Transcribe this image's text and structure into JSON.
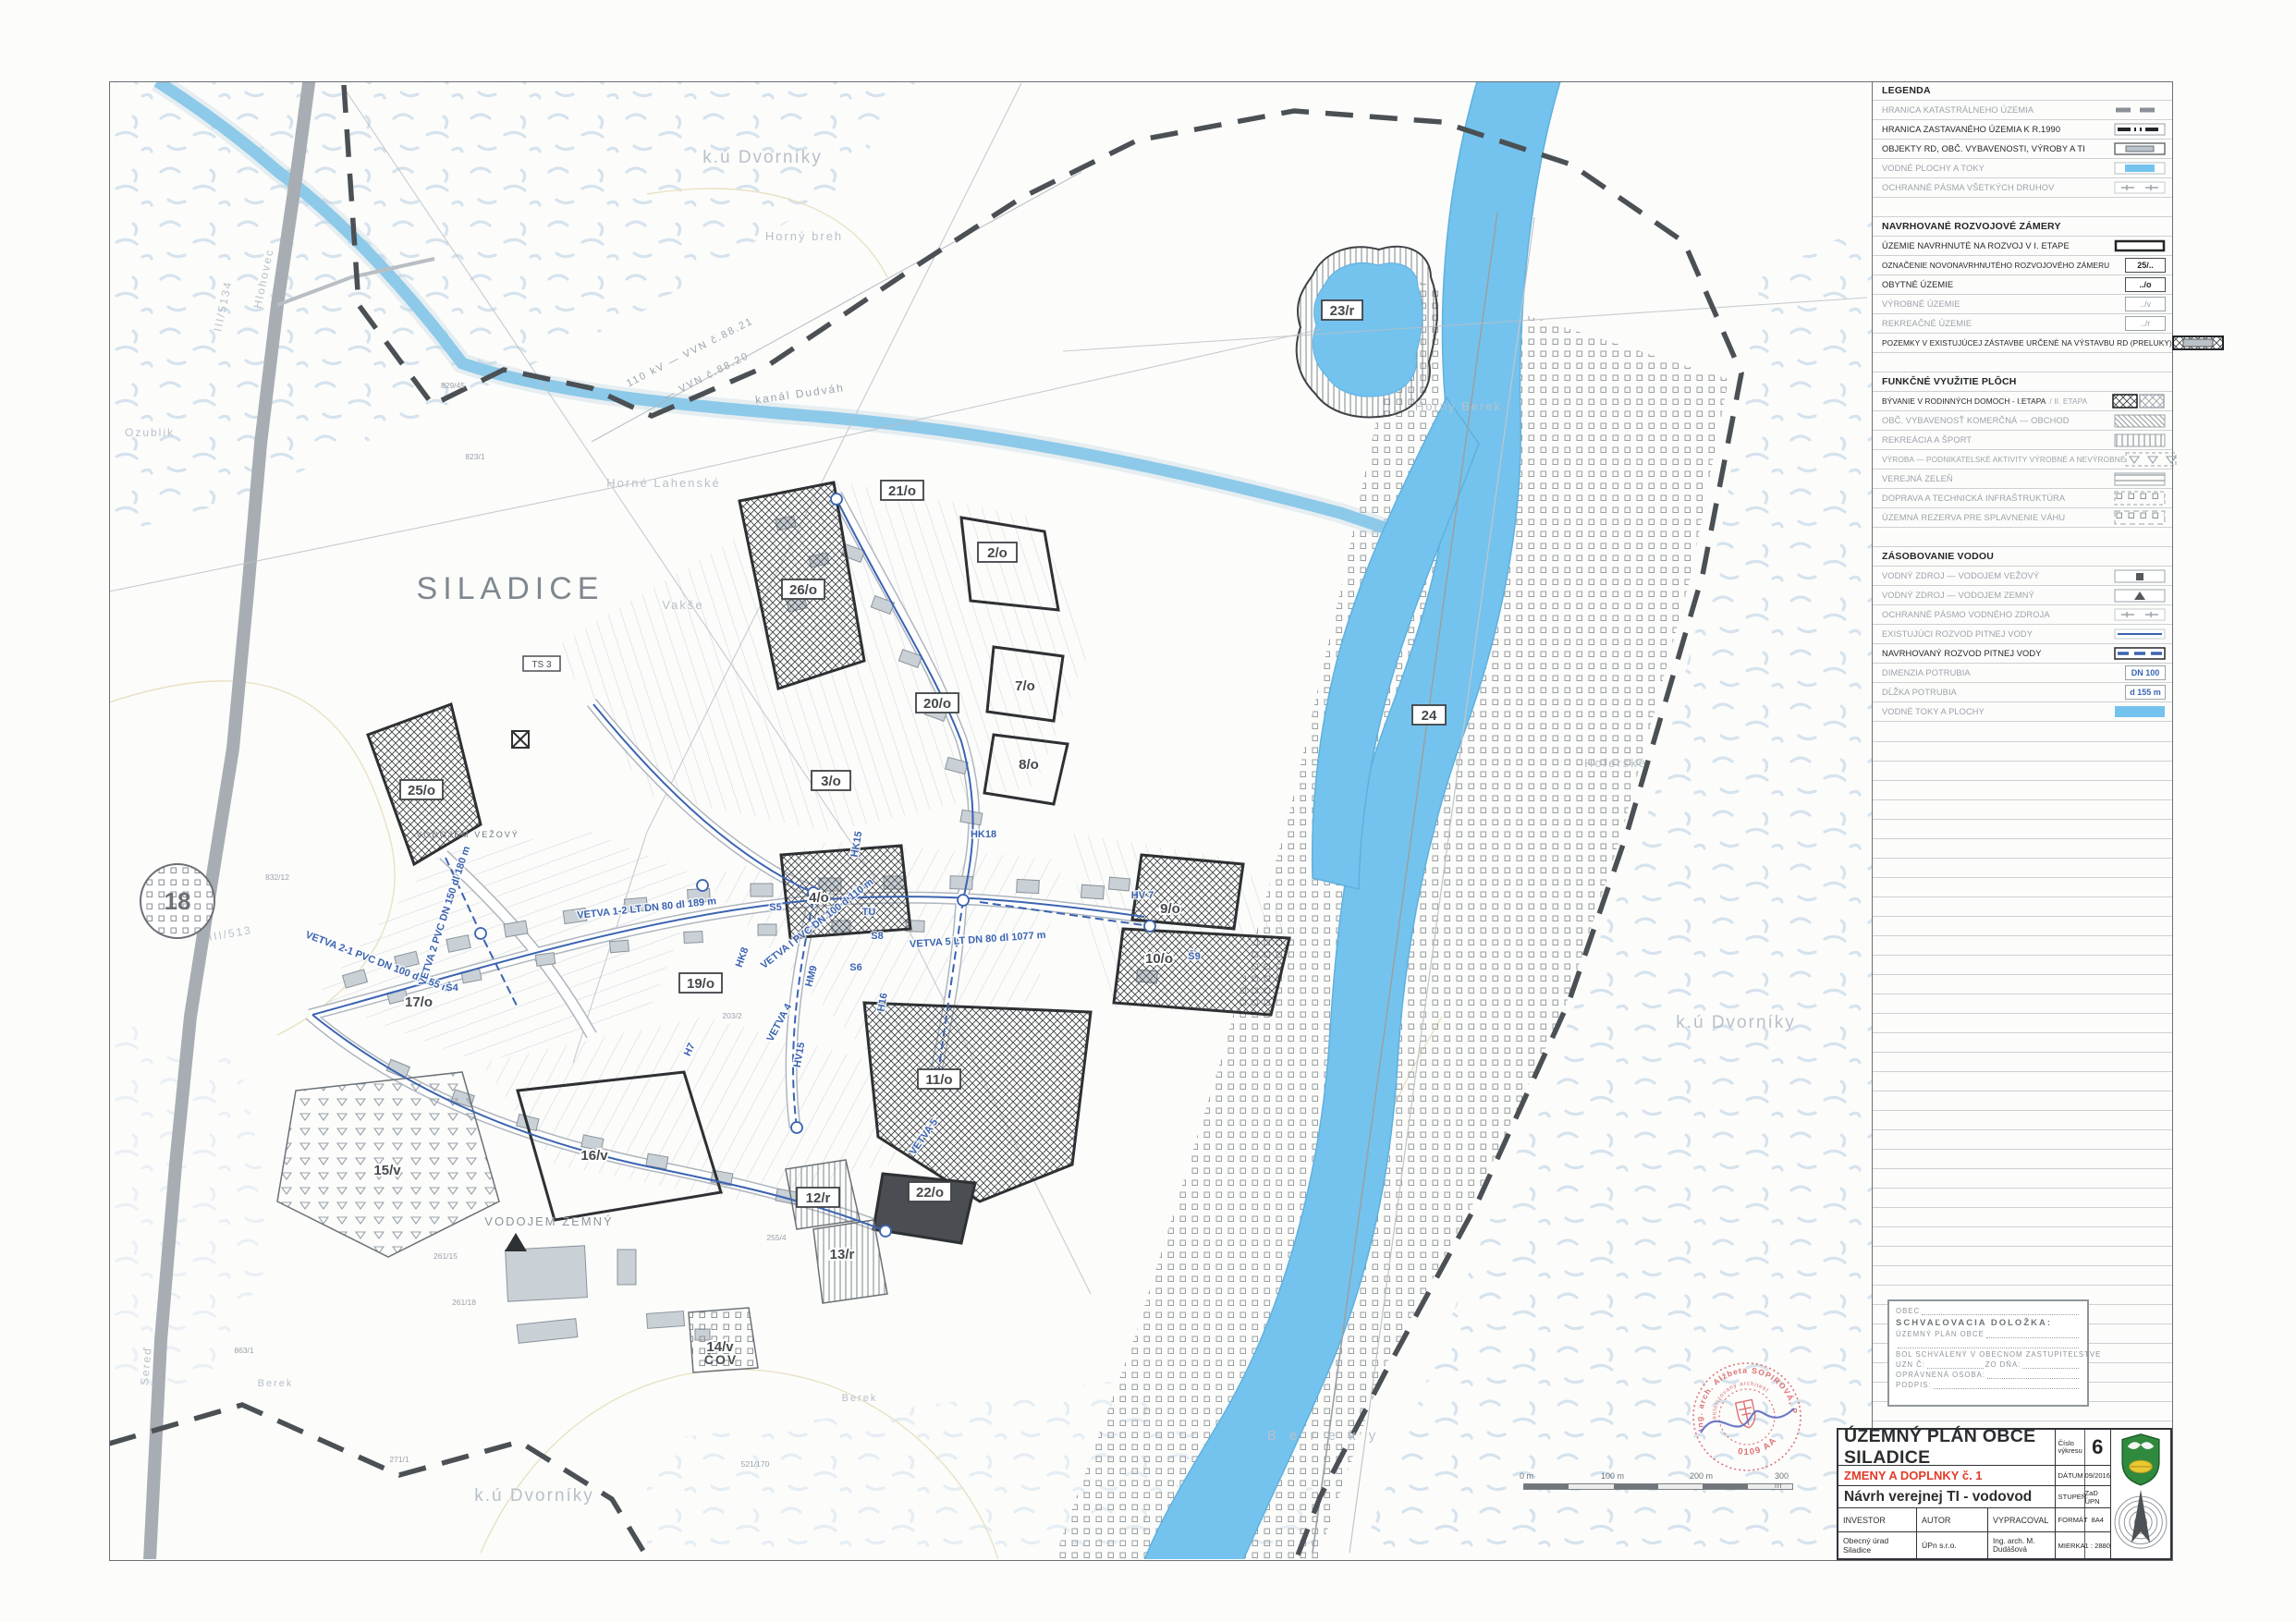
{
  "legend": {
    "title": "LEGENDA",
    "sections": [
      {
        "header": null,
        "items": [
          {
            "label": "HRANICA KATASTRÁLNEHO ÚZEMIA"
          },
          {
            "label": "HRANICA ZASTAVANÉHO ÚZEMIA K R.1990"
          },
          {
            "label": "OBJEKTY RD, OBČ. VYBAVENOSTI, VÝROBY A TI"
          },
          {
            "label": "VODNÉ PLOCHY A TOKY"
          },
          {
            "label": "OCHRANNÉ PÁSMA VŠETKÝCH DRUHOV"
          }
        ]
      },
      {
        "header": "NAVRHOVANÉ ROZVOJOVÉ ZÁMERY",
        "items": [
          {
            "label": "ÚZEMIE NAVRHNUTÉ NA ROZVOJ V I. ETAPE"
          },
          {
            "label": "OZNAČENIE NOVONAVRHNUTÉHO ROZVOJOVÉHO ZÁMERU",
            "code": "25/.."
          },
          {
            "label": "OBYTNÉ ÚZEMIE",
            "code": "../o"
          },
          {
            "label": "VÝROBNÉ ÚZEMIE",
            "code": "../v"
          },
          {
            "label": "REKREAČNÉ ÚZEMIE",
            "code": "../r"
          },
          {
            "label": "POZEMKY V EXISTUJÚCEJ ZÁSTAVBE URČENÉ NA VÝSTAVBU RD (PRELUKY)"
          }
        ]
      },
      {
        "header": "FUNKČNÉ VYUŽITIE PLÔCH",
        "items": [
          {
            "label": "BÝVANIE V RODINNÝCH DOMOCH - I.ETAPA",
            "label2": "/ II. ETAPA"
          },
          {
            "label": "OBČ. VYBAVENOSŤ KOMERČNÁ — OBCHOD"
          },
          {
            "label": "REKREÁCIA A ŠPORT"
          },
          {
            "label": "VÝROBA — PODNIKATELSKÉ AKTIVITY VÝROBNÉ A NEVÝROBNÉ"
          },
          {
            "label": "VEREJNÁ ZELEŇ"
          },
          {
            "label": "DOPRAVA A TECHNICKÁ INFRAŠTRUKTÚRA"
          },
          {
            "label": "ÚZEMNÁ REZERVA PRE SPLAVNENIE VÁHU"
          }
        ]
      },
      {
        "header": "ZÁSOBOVANIE VODOU",
        "items": [
          {
            "label": "VODNÝ ZDROJ — VODOJEM VEŽOVÝ"
          },
          {
            "label": "VODNÝ ZDROJ — VODOJEM ZEMNÝ"
          },
          {
            "label": "OCHRANNÉ PÁSMO VODNÉHO ZDROJA"
          },
          {
            "label": "EXISTUJÚCI ROZVOD PITNEJ VODY"
          },
          {
            "label": "NAVRHOVANÝ ROZVOD PITNEJ VODY"
          },
          {
            "label": "DIMENZIA POTRUBIA",
            "code": "DN 100"
          },
          {
            "label": "DĹŽKA POTRUBIA",
            "code": "d 155 m"
          },
          {
            "label": "VODNÉ TOKY A PLOCHY"
          }
        ]
      }
    ]
  },
  "approval_box": {
    "obec": "OBEC",
    "title": "SCHVAĽOVACIA DOLOŽKA:",
    "line1": "ÚZEMNÝ PLÁN OBCE",
    "line2": "BOL SCHVÁLENÝ V OBECNOM ZASTUPITEĽSTVE",
    "uzn": "UZN Č:",
    "zodna": "ZO DŇA:",
    "osoba": "OPRÁVNENÁ OSOBA:",
    "podpis": "PODPIS:"
  },
  "title_block": {
    "title": "ÚZEMNÝ PLÁN OBCE SILADICE",
    "subtitle": "ZMENY A DOPLNKY č. 1",
    "drawing": "Návrh verejnej TI - vodovod",
    "investor_label": "INVESTOR",
    "investor": "Obecný úrad Siladice",
    "autor_label": "AUTOR",
    "autor": "ÚPn s.r.o.",
    "vypracoval_label": "VYPRACOVAL",
    "vypracoval": "Ing. arch. M. Dudášová",
    "cislo_label": "Číslo výkresu",
    "cislo": "6",
    "datum_label": "DÁTUM",
    "datum": "09/2016",
    "stupen_label": "STUPEŇ",
    "stupen": "ZaD ÚPN",
    "format_label": "FORMÁT",
    "format": "8A4",
    "mierka_label": "MIERKA",
    "mierka": "1 : 2880"
  },
  "scale_bar": {
    "labels": [
      "0 m",
      "100 m",
      "200 m",
      "300 m"
    ]
  },
  "stamp": {
    "ring_text": "Ing. arch. Alžbeta SOPIROVÁ, PhD.",
    "inner_text": "autorizovaný architekt",
    "number": "0109 AA"
  },
  "map": {
    "big_label": "SILADICE",
    "place_labels": [
      "k.ú Dvorníky",
      "k.ú Dvorníky",
      "k.ú Dvorníky",
      "Horný breh",
      "Horné Lahenské",
      "Vakše",
      "Hoferské",
      "Horný Berek",
      "Ozublik",
      "B e r e k y",
      "Berek",
      "Berek",
      "Hlohovec",
      "III/5134",
      "Sereď",
      "III/513",
      "kanál Dudváh",
      "110 kV — VVN č.88.21",
      "— VVN č.88.20",
      "VODOJEM ZEMNÝ",
      "VODOJEM VEŽOVÝ",
      "ČOV"
    ],
    "plot_labels": [
      "25/o",
      "26/o",
      "2/o",
      "21/o",
      "20/o",
      "3/o",
      "19/o",
      "11/o",
      "12/r",
      "22/o",
      "23/r",
      "24",
      "7/o",
      "8/o",
      "4/o",
      "9/o",
      "10/o",
      "17/o",
      "15/v",
      "16/v",
      "13/r",
      "14/v"
    ],
    "road_circle": "18",
    "pipe_labels": [
      "VETVA 2-1 PVC DN 100 dl 155 m",
      "VETVA 2 PVC DN 150 dl 180 m",
      "VETVA I PVC DN 100 d 110 m",
      "VETVA 5 LT DN 80 dl 1077 m",
      "VETVA 1-2 LT DN 80 dl 189 m",
      "VETVA 4",
      "VETVA 5"
    ],
    "node_labels": [
      "HK15",
      "HK18",
      "HV15",
      "HV 7",
      "Š9",
      "Š4",
      "S5",
      "S8",
      "S6",
      "H16",
      "HM9",
      "HK8",
      "H7",
      "TU",
      "TS 3"
    ],
    "parcel_numbers": [
      "832/12",
      "823/1",
      "829/45",
      "261/18",
      "261/15",
      "255/4",
      "203/2",
      "271/1",
      "521/170",
      "863/1"
    ]
  },
  "colors": {
    "water": "#74c3ee",
    "pipe_blue": "#3b63b0",
    "accent_red": "#e23a28",
    "stamp_red": "#d95f5f",
    "arms_green": "#2f8a3d"
  }
}
